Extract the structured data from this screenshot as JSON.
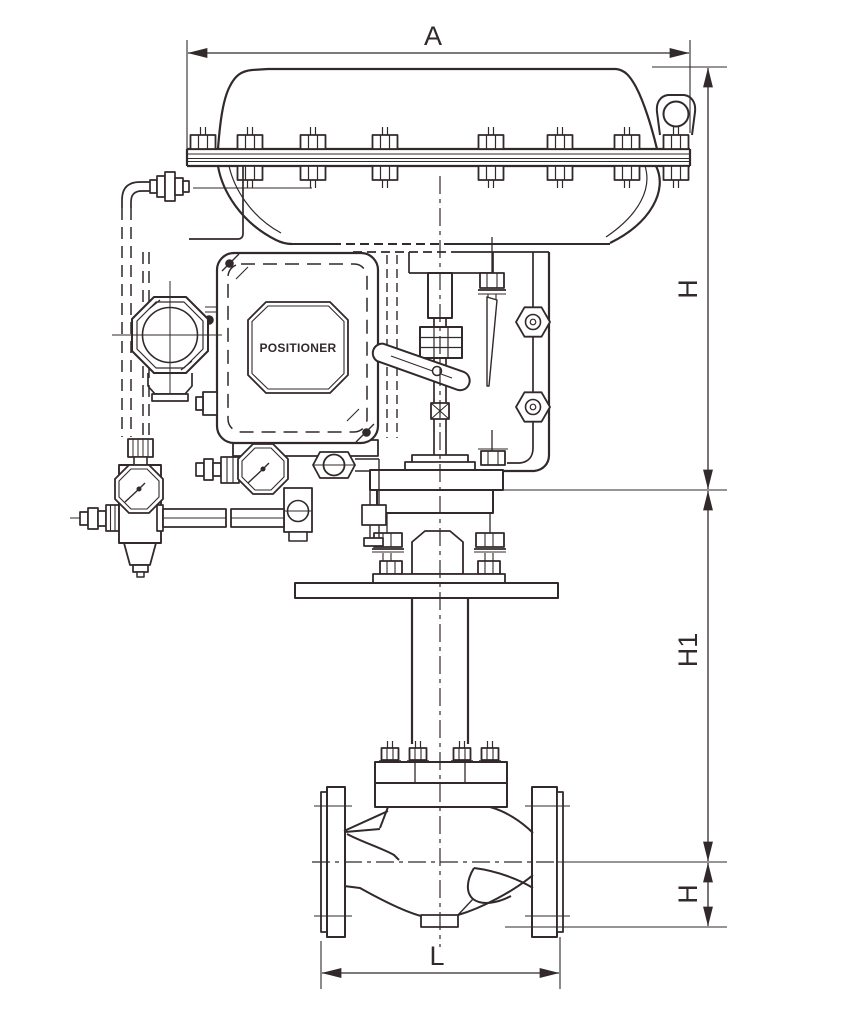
{
  "drawing": {
    "title": "Pneumatic diaphragm control valve - dimensional outline drawing",
    "labels": {
      "overall_width": "A",
      "actuator_height": "H",
      "yoke_height": "H1",
      "center_to_base": "H",
      "face_to_face": "L"
    },
    "positioner": {
      "nameplate": "POSITIONER"
    },
    "colors": {
      "line": "#32292a",
      "background": "#ffffff"
    }
  }
}
